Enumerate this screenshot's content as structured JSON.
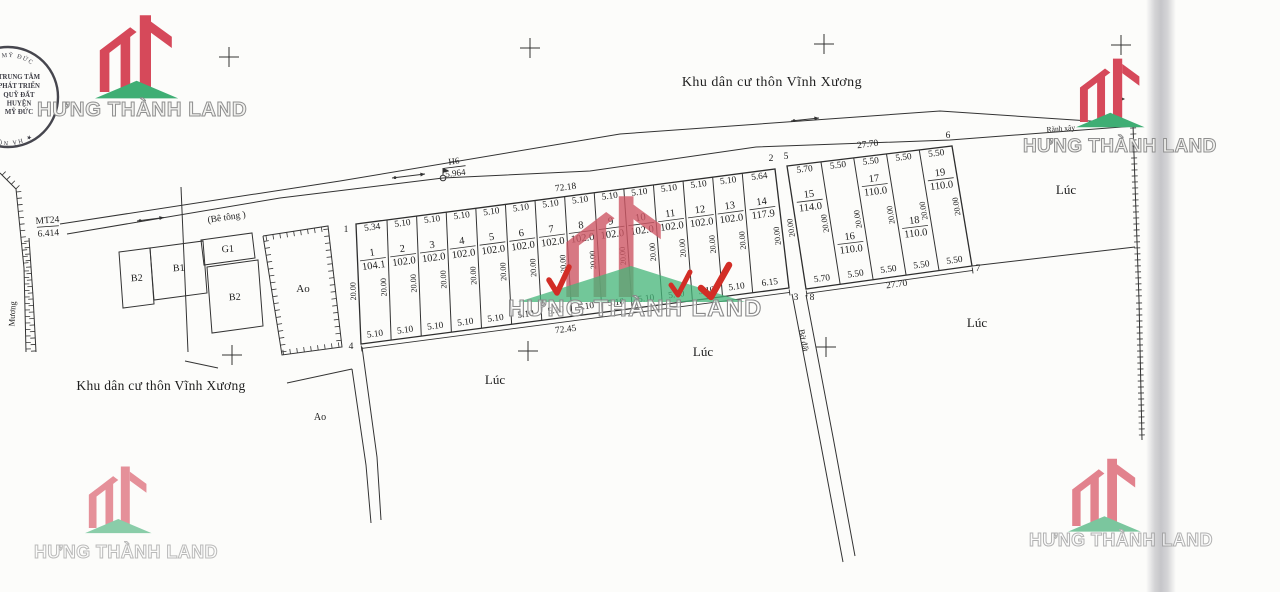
{
  "brand": {
    "name": "HƯNG THÀNH LAND",
    "red": "#d6495a",
    "green": "#3fae74"
  },
  "stamp": {
    "arc_top": "N H. MỸ ĐỨC",
    "arc_bottom": "★ HÀ NỘI ★",
    "lines": [
      "TRUNG TÂM",
      "PHÁT TRIỂN",
      "QUỸ ĐẤT",
      "HUYỆN",
      "MỸ ĐỨC"
    ]
  },
  "labels": {
    "residential": "Khu dân cư thôn Vĩnh Xương",
    "road": "(Bê tông )",
    "ditch": "Rãnh xây",
    "lane": "Bờ đất",
    "canal": "Mương",
    "field": "Lúc",
    "pond": "Ao"
  },
  "markers": {
    "h6": {
      "name": "H6",
      "value": "5.964"
    },
    "mt24": {
      "name": "MT24",
      "value": "6.414"
    }
  },
  "buildings": [
    "B2",
    "B1",
    "G1",
    "B2"
  ],
  "blocks": [
    {
      "name": "block-1-14",
      "corners": [
        "1",
        "2",
        "3",
        "4"
      ],
      "top_total": "72.18",
      "bottom_total": "72.45",
      "depth": "20.00",
      "plots": [
        {
          "no": "1",
          "area": "104.1",
          "w_top": "5.34",
          "w_bot": "5.10"
        },
        {
          "no": "2",
          "area": "102.0",
          "w_top": "5.10",
          "w_bot": "5.10"
        },
        {
          "no": "3",
          "area": "102.0",
          "w_top": "5.10",
          "w_bot": "5.10"
        },
        {
          "no": "4",
          "area": "102.0",
          "w_top": "5.10",
          "w_bot": "5.10"
        },
        {
          "no": "5",
          "area": "102.0",
          "w_top": "5.10",
          "w_bot": "5.10"
        },
        {
          "no": "6",
          "area": "102.0",
          "w_top": "5.10",
          "w_bot": "5.10"
        },
        {
          "no": "7",
          "area": "102.0",
          "w_top": "5.10",
          "w_bot": "5.10"
        },
        {
          "no": "8",
          "area": "102.0",
          "w_top": "5.10",
          "w_bot": "5.10"
        },
        {
          "no": "9",
          "area": "102.0",
          "w_top": "5.10",
          "w_bot": "5.10"
        },
        {
          "no": "10",
          "area": "102.0",
          "w_top": "5.10",
          "w_bot": "5.10"
        },
        {
          "no": "11",
          "area": "102.0",
          "w_top": "5.10",
          "w_bot": "5.10"
        },
        {
          "no": "12",
          "area": "102.0",
          "w_top": "5.10",
          "w_bot": "5.10"
        },
        {
          "no": "13",
          "area": "102.0",
          "w_top": "5.10",
          "w_bot": "5.10"
        },
        {
          "no": "14",
          "area": "117.9",
          "w_top": "5.64",
          "w_bot": "6.15"
        }
      ]
    },
    {
      "name": "block-15-19",
      "corners": [
        "5",
        "6",
        "7",
        "8"
      ],
      "top_total": "27.70",
      "bottom_total": "27.70",
      "depth": "20.00",
      "plots": [
        {
          "no": "15",
          "area": "114.0",
          "w_top": "5.70",
          "w_bot": "5.70"
        },
        {
          "no": "16",
          "area": "110.0",
          "w_top": "5.50",
          "w_bot": "5.50"
        },
        {
          "no": "17",
          "area": "110.0",
          "w_top": "5.50",
          "w_bot": "5.50"
        },
        {
          "no": "18",
          "area": "110.0",
          "w_top": "5.50",
          "w_bot": "5.50"
        },
        {
          "no": "19",
          "area": "110.0",
          "w_top": "5.50",
          "w_bot": "5.50"
        }
      ]
    }
  ]
}
